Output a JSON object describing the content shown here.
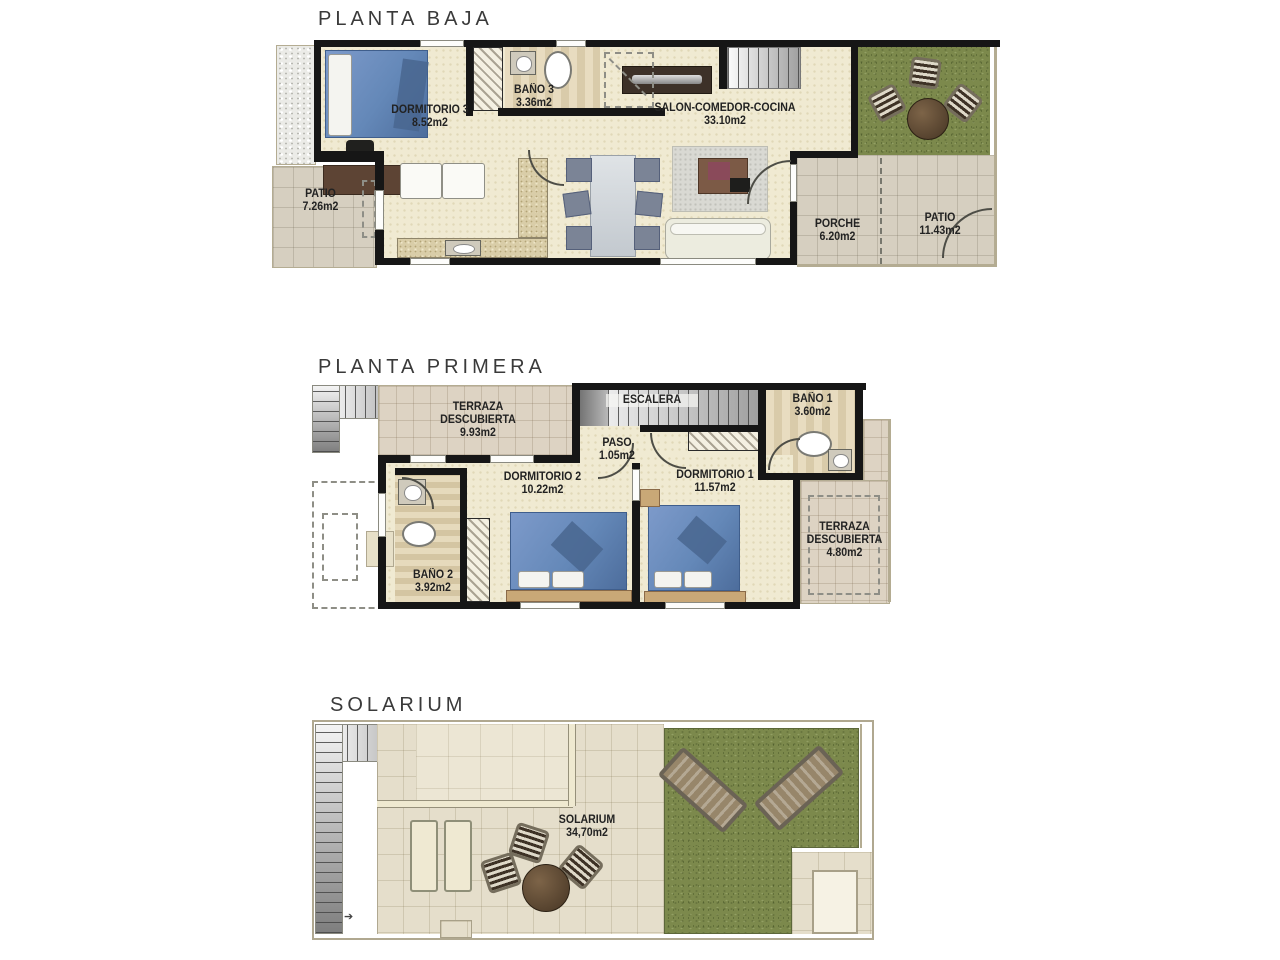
{
  "floors": [
    {
      "id": "planta-baja",
      "title": "PLANTA BAJA",
      "rooms": [
        {
          "name": "DORMITORIO 3",
          "area": "8.52m2"
        },
        {
          "name": "BAÑO 3",
          "area": "3.36m2"
        },
        {
          "name": "SALON-COMEDOR-COCINA",
          "area": "33.10m2"
        },
        {
          "name": "PATIO",
          "area": "7.26m2"
        },
        {
          "name": "PORCHE",
          "area": "6.20m2"
        },
        {
          "name": "PATIO",
          "area": "11.43m2"
        }
      ]
    },
    {
      "id": "planta-primera",
      "title": "PLANTA PRIMERA",
      "rooms": [
        {
          "name": "TERRAZA DESCUBIERTA",
          "area": "9.93m2"
        },
        {
          "name": "ESCALERA",
          "area": ""
        },
        {
          "name": "PASO",
          "area": "1.05m2"
        },
        {
          "name": "BAÑO 1",
          "area": "3.60m2"
        },
        {
          "name": "DORMITORIO 2",
          "area": "10.22m2"
        },
        {
          "name": "DORMITORIO 1",
          "area": "11.57m2"
        },
        {
          "name": "BAÑO 2",
          "area": "3.92m2"
        },
        {
          "name": "TERRAZA DESCUBIERTA",
          "area": "4.80m2"
        }
      ]
    },
    {
      "id": "solarium",
      "title": "SOLARIUM",
      "rooms": [
        {
          "name": "SOLARIUM",
          "area": "34,70m2"
        }
      ]
    }
  ],
  "colors": {
    "wall": "#161616",
    "floor-cream": "#f0ead2",
    "tile-gray": "#d6cfc0",
    "tile-terrace": "#ddd3c3",
    "grass": "#7c894c",
    "bed-blue": "#6488b8",
    "label-text": "#222222"
  }
}
